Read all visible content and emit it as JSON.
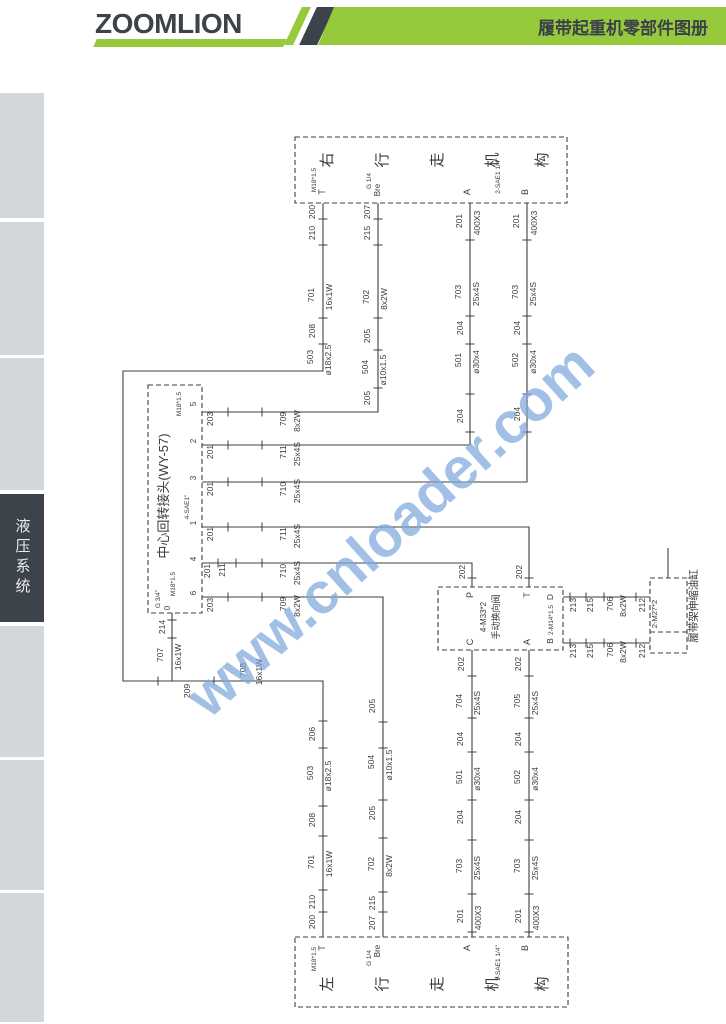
{
  "header": {
    "logo": "ZOOMLION",
    "title": "履带起重机零部件图册",
    "green": "#97c93c",
    "dark": "#3d434b"
  },
  "sidebar": {
    "tabs": [
      {
        "label": "",
        "y": 93,
        "h": 125,
        "active": false
      },
      {
        "label": "",
        "y": 222,
        "h": 133,
        "active": false
      },
      {
        "label": "",
        "y": 358,
        "h": 132,
        "active": false
      },
      {
        "label": "液压系统",
        "y": 494,
        "h": 128,
        "active": true
      },
      {
        "label": "",
        "y": 626,
        "h": 131,
        "active": false
      },
      {
        "label": "",
        "y": 760,
        "h": 130,
        "active": false
      },
      {
        "label": "",
        "y": 893,
        "h": 129,
        "active": false
      }
    ]
  },
  "watermark": {
    "text": "www.cnloader.com",
    "color": "#7fa9dc"
  },
  "diagram": {
    "stroke": "#3f3f3f",
    "ink": "#3a3a3a",
    "boxes": [
      {
        "name": "right-travel-box",
        "x": 295,
        "y": 137,
        "w": 272,
        "h": 66
      },
      {
        "name": "left-travel-box",
        "x": 295,
        "y": 937,
        "w": 273,
        "h": 70
      },
      {
        "name": "rotary-joint-box",
        "x": 148,
        "y": 385,
        "w": 54,
        "h": 228
      },
      {
        "name": "valve-box",
        "x": 438,
        "y": 587,
        "w": 125,
        "h": 63
      },
      {
        "name": "cylinder-box",
        "x": 650,
        "y": 578,
        "w": 37,
        "h": 75
      }
    ],
    "dashed_segments": [
      [
        650,
        632,
        687,
        632
      ]
    ],
    "polylines": [
      {
        "name": "t-loop-line",
        "pts": [
          [
            323,
            203
          ],
          [
            323,
            371
          ],
          [
            123,
            371
          ],
          [
            123,
            681
          ],
          [
            323,
            681
          ],
          [
            323,
            937
          ]
        ]
      },
      {
        "name": "bre-top-line",
        "pts": [
          [
            378,
            203
          ],
          [
            378,
            412
          ],
          [
            202,
            412
          ]
        ]
      },
      {
        "name": "a-top-line",
        "pts": [
          [
            470,
            203
          ],
          [
            470,
            445
          ],
          [
            202,
            445
          ]
        ]
      },
      {
        "name": "b-top-line",
        "pts": [
          [
            527,
            203
          ],
          [
            527,
            482
          ],
          [
            202,
            482
          ]
        ]
      },
      {
        "name": "port1-line",
        "pts": [
          [
            202,
            527
          ],
          [
            529,
            527
          ],
          [
            529,
            587
          ]
        ]
      },
      {
        "name": "port4-line",
        "pts": [
          [
            202,
            563
          ],
          [
            472,
            563
          ],
          [
            472,
            587
          ]
        ]
      },
      {
        "name": "port6-line",
        "pts": [
          [
            202,
            597
          ],
          [
            383,
            597
          ],
          [
            383,
            937
          ]
        ]
      },
      {
        "name": "port0-line",
        "pts": [
          [
            172,
            613
          ],
          [
            172,
            681
          ]
        ]
      },
      {
        "name": "valve-c-line",
        "pts": [
          [
            472,
            650
          ],
          [
            472,
            937
          ]
        ]
      },
      {
        "name": "valve-a-line",
        "pts": [
          [
            529,
            650
          ],
          [
            529,
            937
          ]
        ]
      },
      {
        "name": "valve-d-line",
        "pts": [
          [
            563,
            597
          ],
          [
            650,
            597
          ]
        ]
      },
      {
        "name": "valve-b-line",
        "pts": [
          [
            563,
            643
          ],
          [
            650,
            643
          ]
        ]
      },
      {
        "name": "cylinder-stub",
        "pts": [
          [
            668,
            548
          ],
          [
            668,
            578
          ]
        ]
      }
    ],
    "ticks": [
      [
        323,
        219,
        "h"
      ],
      [
        323,
        245,
        "h"
      ],
      [
        323,
        318,
        "h"
      ],
      [
        323,
        344,
        "h"
      ],
      [
        323,
        721,
        "h"
      ],
      [
        323,
        748,
        "h"
      ],
      [
        323,
        806,
        "h"
      ],
      [
        323,
        836,
        "h"
      ],
      [
        323,
        890,
        "h"
      ],
      [
        323,
        912,
        "h"
      ],
      [
        378,
        219,
        "h"
      ],
      [
        378,
        245,
        "h"
      ],
      [
        378,
        318,
        "h"
      ],
      [
        378,
        350,
        "h"
      ],
      [
        378,
        388,
        "h"
      ],
      [
        470,
        240,
        "h"
      ],
      [
        470,
        316,
        "h"
      ],
      [
        470,
        344,
        "h"
      ],
      [
        470,
        394,
        "h"
      ],
      [
        470,
        432,
        "h"
      ],
      [
        527,
        240,
        "h"
      ],
      [
        527,
        316,
        "h"
      ],
      [
        527,
        344,
        "h"
      ],
      [
        527,
        394,
        "h"
      ],
      [
        527,
        432,
        "h"
      ],
      [
        383,
        722,
        "h"
      ],
      [
        383,
        748,
        "h"
      ],
      [
        383,
        800,
        "h"
      ],
      [
        383,
        838,
        "h"
      ],
      [
        383,
        892,
        "h"
      ],
      [
        383,
        912,
        "h"
      ],
      [
        472,
        578,
        "h"
      ],
      [
        472,
        676,
        "h"
      ],
      [
        472,
        718,
        "h"
      ],
      [
        472,
        752,
        "h"
      ],
      [
        472,
        800,
        "h"
      ],
      [
        472,
        840,
        "h"
      ],
      [
        472,
        894,
        "h"
      ],
      [
        472,
        932,
        "h"
      ],
      [
        529,
        578,
        "h"
      ],
      [
        529,
        676,
        "h"
      ],
      [
        529,
        718,
        "h"
      ],
      [
        529,
        752,
        "h"
      ],
      [
        529,
        800,
        "h"
      ],
      [
        529,
        840,
        "h"
      ],
      [
        529,
        894,
        "h"
      ],
      [
        529,
        932,
        "h"
      ],
      [
        172,
        620,
        "h"
      ],
      [
        172,
        638,
        "h"
      ],
      [
        158,
        681,
        "v"
      ],
      [
        214,
        681,
        "v"
      ],
      [
        228,
        412,
        "v"
      ],
      [
        262,
        412,
        "v"
      ],
      [
        228,
        445,
        "v"
      ],
      [
        262,
        445,
        "v"
      ],
      [
        228,
        482,
        "v"
      ],
      [
        262,
        482,
        "v"
      ],
      [
        228,
        527,
        "v"
      ],
      [
        262,
        527,
        "v"
      ],
      [
        218,
        563,
        "v"
      ],
      [
        236,
        563,
        "v"
      ],
      [
        262,
        563,
        "v"
      ],
      [
        228,
        597,
        "v"
      ],
      [
        262,
        597,
        "v"
      ],
      [
        570,
        597,
        "v"
      ],
      [
        586,
        597,
        "v"
      ],
      [
        604,
        597,
        "v"
      ],
      [
        636,
        597,
        "v"
      ],
      [
        570,
        643,
        "v"
      ],
      [
        586,
        643,
        "v"
      ],
      [
        604,
        643,
        "v"
      ],
      [
        636,
        643,
        "v"
      ]
    ],
    "labels": [
      [
        "右",
        332,
        160,
        15
      ],
      [
        "行",
        387,
        160,
        15
      ],
      [
        "走",
        442,
        160,
        15
      ],
      [
        "机",
        497,
        160,
        15
      ],
      [
        "构",
        547,
        160,
        15
      ],
      [
        "M18*1.5",
        316,
        180,
        6.5
      ],
      [
        "T",
        325,
        192,
        9
      ],
      [
        "G 1/4",
        371,
        181,
        6.5
      ],
      [
        "Bre",
        380,
        190,
        8
      ],
      [
        "A",
        470,
        192,
        9
      ],
      [
        "2-SAE1 1/4\"",
        500,
        176,
        6.5
      ],
      [
        "B",
        528,
        192,
        9
      ],
      [
        "200",
        315,
        212
      ],
      [
        "210",
        315,
        233
      ],
      [
        "701",
        314,
        295
      ],
      [
        "16x1W",
        332,
        297
      ],
      [
        "208",
        315,
        331
      ],
      [
        "503",
        313,
        357
      ],
      [
        "ø18x2.5",
        331,
        360
      ],
      [
        "207",
        370,
        212
      ],
      [
        "215",
        370,
        233
      ],
      [
        "702",
        369,
        297
      ],
      [
        "8x2W",
        387,
        299
      ],
      [
        "205",
        370,
        336
      ],
      [
        "504",
        368,
        367
      ],
      [
        "ø10x1.5",
        386,
        370
      ],
      [
        "205",
        370,
        398
      ],
      [
        "201",
        462,
        221
      ],
      [
        "400X3",
        480,
        223
      ],
      [
        "703",
        461,
        292
      ],
      [
        "25x4S",
        479,
        294
      ],
      [
        "204",
        463,
        328
      ],
      [
        "501",
        461,
        360
      ],
      [
        "ø30x4",
        479,
        362
      ],
      [
        "204",
        463,
        416
      ],
      [
        "201",
        519,
        221
      ],
      [
        "400X3",
        537,
        223
      ],
      [
        "703",
        518,
        292
      ],
      [
        "25x4S",
        536,
        294
      ],
      [
        "204",
        520,
        328
      ],
      [
        "502",
        518,
        360
      ],
      [
        "ø30x4",
        536,
        362
      ],
      [
        "204",
        520,
        414
      ],
      [
        "203",
        213,
        419
      ],
      [
        "709",
        286,
        419
      ],
      [
        "8x2W",
        300,
        421
      ],
      [
        "201",
        213,
        452
      ],
      [
        "711",
        286,
        452
      ],
      [
        "25x4S",
        300,
        454
      ],
      [
        "201",
        213,
        489
      ],
      [
        "710",
        286,
        489
      ],
      [
        "25x4S",
        300,
        491
      ],
      [
        "201",
        213,
        534
      ],
      [
        "711",
        286,
        534
      ],
      [
        "25x4S",
        300,
        536
      ],
      [
        "201",
        210,
        571
      ],
      [
        "211",
        225,
        570
      ],
      [
        "710",
        286,
        571
      ],
      [
        "25x4S",
        300,
        573
      ],
      [
        "203",
        213,
        605
      ],
      [
        "709",
        286,
        604
      ],
      [
        "8x2W",
        300,
        606
      ],
      [
        "5",
        196,
        404,
        8
      ],
      [
        "2",
        196,
        441,
        8
      ],
      [
        "3",
        196,
        478,
        8
      ],
      [
        "1",
        196,
        523,
        8
      ],
      [
        "4",
        196,
        559,
        8
      ],
      [
        "6",
        196,
        593,
        8
      ],
      [
        "M18*1.5",
        181,
        404,
        6.5
      ],
      [
        "中心回转接头(WY-57)",
        168,
        496,
        13
      ],
      [
        "4-SAE1\"",
        189,
        507,
        6.5
      ],
      [
        "M18*1.5",
        175,
        584,
        6.5
      ],
      [
        "G 3/4\"",
        160,
        599,
        6.5
      ],
      [
        "0",
        170,
        608,
        8
      ],
      [
        "214",
        165,
        627
      ],
      [
        "707",
        163,
        655
      ],
      [
        "16x1W",
        181,
        657
      ],
      [
        "209",
        190,
        691
      ],
      [
        "708",
        246,
        670
      ],
      [
        "16x1W",
        262,
        672
      ],
      [
        "202",
        465,
        572
      ],
      [
        "202",
        522,
        572
      ],
      [
        "P",
        473,
        595,
        9
      ],
      [
        "T",
        530,
        595,
        9
      ],
      [
        "C",
        473,
        642,
        9
      ],
      [
        "A",
        530,
        642,
        9
      ],
      [
        "4-M33*2",
        486,
        617,
        8
      ],
      [
        "手动换向阀",
        499,
        617,
        9
      ],
      [
        "D",
        553,
        597,
        8.5
      ],
      [
        "2-M14*1.5",
        553,
        620,
        6.5
      ],
      [
        "B",
        553,
        641,
        8.5
      ],
      [
        "202",
        464,
        664
      ],
      [
        "202",
        521,
        664
      ],
      [
        "213",
        576,
        605
      ],
      [
        "215",
        593,
        605
      ],
      [
        "706",
        613,
        604
      ],
      [
        "8x2W",
        626,
        606
      ],
      [
        "212",
        645,
        605
      ],
      [
        "213",
        576,
        651
      ],
      [
        "215",
        593,
        651
      ],
      [
        "706",
        613,
        650
      ],
      [
        "8x2W",
        626,
        652
      ],
      [
        "212",
        645,
        651
      ],
      [
        "2-M27*2",
        657,
        614,
        7.5
      ],
      [
        "履带架伸缩油缸",
        697,
        606,
        10.5
      ],
      [
        "206",
        315,
        734
      ],
      [
        "503",
        313,
        773
      ],
      [
        "ø18x2.5",
        331,
        776
      ],
      [
        "208",
        315,
        820
      ],
      [
        "701",
        314,
        862
      ],
      [
        "16x1W",
        332,
        864
      ],
      [
        "210",
        315,
        902
      ],
      [
        "200",
        315,
        922
      ],
      [
        "205",
        375,
        706
      ],
      [
        "504",
        374,
        762
      ],
      [
        "ø10x1.5",
        392,
        765
      ],
      [
        "205",
        375,
        813
      ],
      [
        "702",
        374,
        864
      ],
      [
        "8x2W",
        392,
        866
      ],
      [
        "215",
        375,
        903
      ],
      [
        "207",
        375,
        923
      ],
      [
        "704",
        462,
        701
      ],
      [
        "25x4S",
        480,
        703
      ],
      [
        "204",
        463,
        739
      ],
      [
        "501",
        462,
        777
      ],
      [
        "ø30x4",
        480,
        779
      ],
      [
        "204",
        463,
        817
      ],
      [
        "703",
        462,
        866
      ],
      [
        "25x4S",
        480,
        868
      ],
      [
        "201",
        463,
        916
      ],
      [
        "400X3",
        481,
        918
      ],
      [
        "705",
        520,
        701
      ],
      [
        "25x4S",
        538,
        703
      ],
      [
        "204",
        521,
        739
      ],
      [
        "502",
        520,
        777
      ],
      [
        "ø30x4",
        538,
        779
      ],
      [
        "204",
        521,
        817
      ],
      [
        "703",
        520,
        866
      ],
      [
        "25x4S",
        538,
        868
      ],
      [
        "201",
        521,
        916
      ],
      [
        "400X3",
        539,
        918
      ],
      [
        "左",
        332,
        984,
        15
      ],
      [
        "行",
        387,
        984,
        15
      ],
      [
        "走",
        442,
        984,
        15
      ],
      [
        "机",
        497,
        984,
        15
      ],
      [
        "构",
        547,
        984,
        15
      ],
      [
        "M18*1.5",
        316,
        959,
        6.5
      ],
      [
        "T",
        325,
        948,
        9
      ],
      [
        "G 1/4",
        371,
        958,
        6.5
      ],
      [
        "Bre",
        380,
        951,
        8
      ],
      [
        "A",
        470,
        948,
        9
      ],
      [
        "2-SAE1 1/4\"",
        500,
        963,
        6.5
      ],
      [
        "B",
        528,
        948,
        9
      ]
    ]
  }
}
